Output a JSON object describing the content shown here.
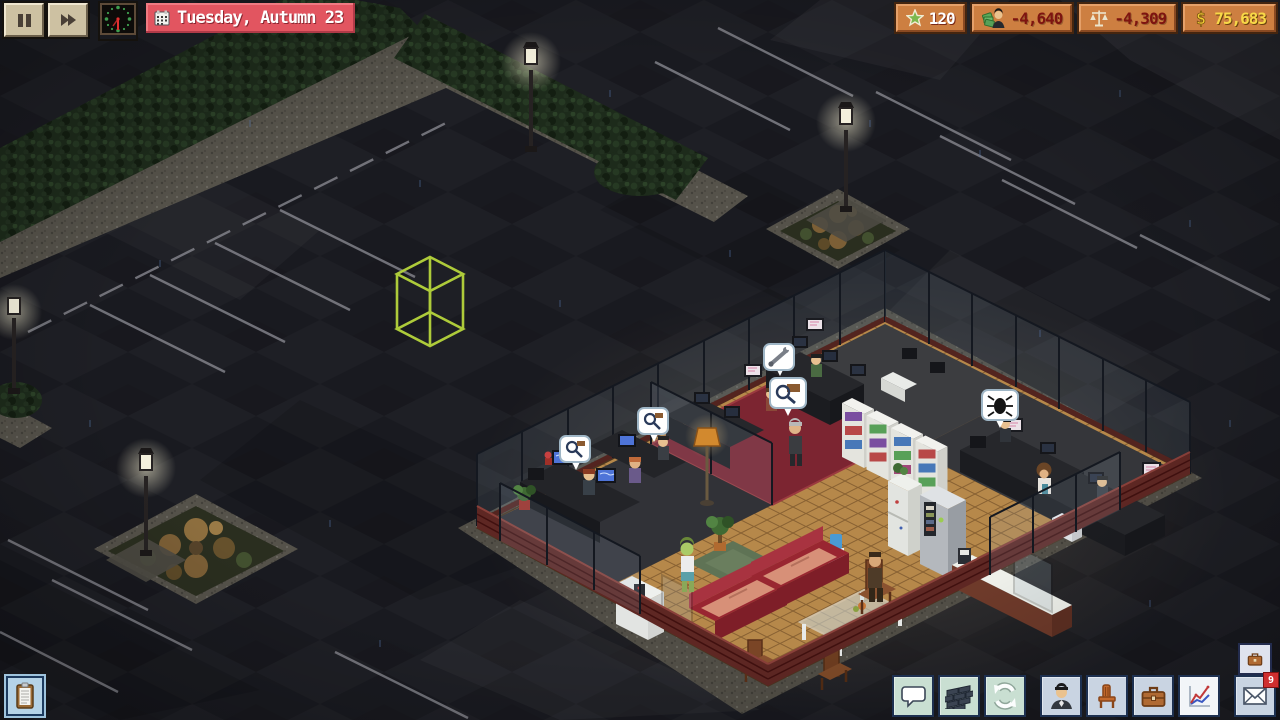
{
  "hud": {
    "date_label": "Tuesday, Autumn 23",
    "resources": {
      "fans": "120",
      "payroll": "-4,640",
      "net": "-4,309",
      "cash": "75,683"
    },
    "mail_badge": "9"
  },
  "icons": {
    "top_left": [
      "pause",
      "fast-forward",
      "analog-clock",
      "calendar"
    ],
    "badges": [
      "star",
      "payroll-person-with-cash",
      "scales",
      "dollar-sign"
    ],
    "toolbar": [
      "chat-bubble",
      "brick-wall",
      "refresh-arrows",
      "employee",
      "chair",
      "briefcase",
      "line-chart",
      "mail-envelope"
    ],
    "misc": [
      "clipboard",
      "mini-briefcase"
    ]
  },
  "scene": {
    "cursor": "green-wireframe-placement-box",
    "speech_bubbles": [
      "magnifier",
      "magnifier",
      "magnifier",
      "wrench",
      "bug"
    ],
    "props": [
      "street-lamps",
      "hedges",
      "planters",
      "bookshelves",
      "red-sofas",
      "glass-table",
      "fridge",
      "vending-machine",
      "reception-counter",
      "office-desks"
    ]
  },
  "colors": {
    "banner": "#e25560",
    "badge_bg": "#cd7f41",
    "negative_text": "#7e1410",
    "cash_text": "#f8d847",
    "cursor": "#b6d53c",
    "night_asphalt": "#191a20"
  }
}
